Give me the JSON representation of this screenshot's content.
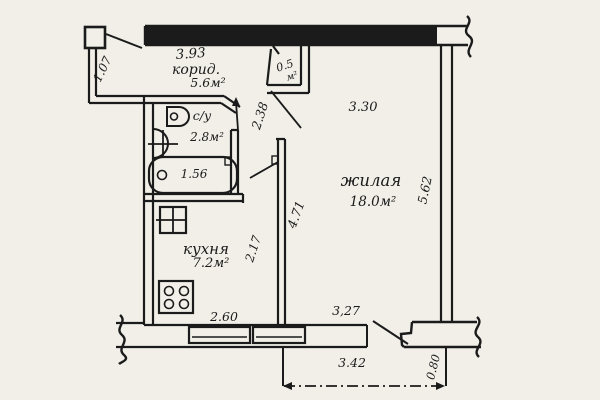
{
  "canvas": {
    "background": "#f1efe8",
    "ink": "#1b1b1b",
    "type": "hand-drawn apartment floor plan"
  },
  "rooms": {
    "corridor": {
      "label": "корид.",
      "area": "5.6м²",
      "dim_length": "3.93",
      "dim_entry": "1.07",
      "dim_passage": "2.38"
    },
    "closet": {
      "area_value": "0.5",
      "area_unit": "м²"
    },
    "bathroom": {
      "label": "с/у",
      "area": "2.8м²",
      "dim_bathtub": "1.56"
    },
    "living_room": {
      "label": "жилая",
      "area": "18.0м²",
      "dim_top": "3.30",
      "dim_right": "5.62",
      "dim_left": "4.71",
      "dim_window": "3,27"
    },
    "kitchen": {
      "label": "кухня",
      "area": "7.2м²",
      "dim_wall": "2.17",
      "dim_window": "2.60"
    }
  },
  "balcony": {
    "dim_width": "3.42",
    "dim_depth": "0.80"
  }
}
